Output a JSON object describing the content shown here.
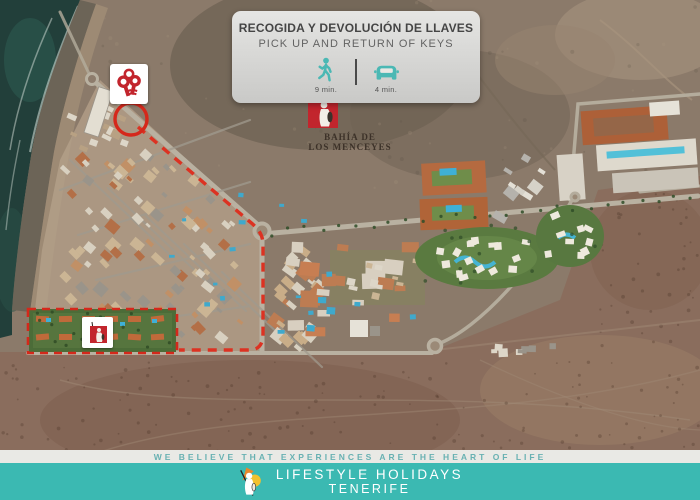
{
  "colors": {
    "brand_teal": "#3bb9b2",
    "tagline_teal": "#68b1b2",
    "route_red": "#d5281b",
    "logo_red": "#c2252d"
  },
  "card": {
    "title_es": "RECOGIDA Y DEVOLUCIÓN DE LLAVES",
    "title_en": "PICK UP AND RETURN OF KEYS",
    "walk": {
      "icon": "walking-icon",
      "time": "9 min."
    },
    "drive": {
      "icon": "car-icon",
      "time": "4 min."
    }
  },
  "map": {
    "pickup_marker": {
      "icon": "keys-icon"
    },
    "resort_logo": {
      "line1": "BAHÍA DE",
      "line2": "LOS MENCEYES"
    },
    "route_style": "red-dashed",
    "highlighted_area": "resort-boundary"
  },
  "footer": {
    "tagline": "WE BELIEVE THAT EXPERIENCES ARE THE HEART OF LIFE",
    "brand_line1": "LIFESTYLE HOLIDAYS",
    "brand_line2": "TENERIFE"
  }
}
